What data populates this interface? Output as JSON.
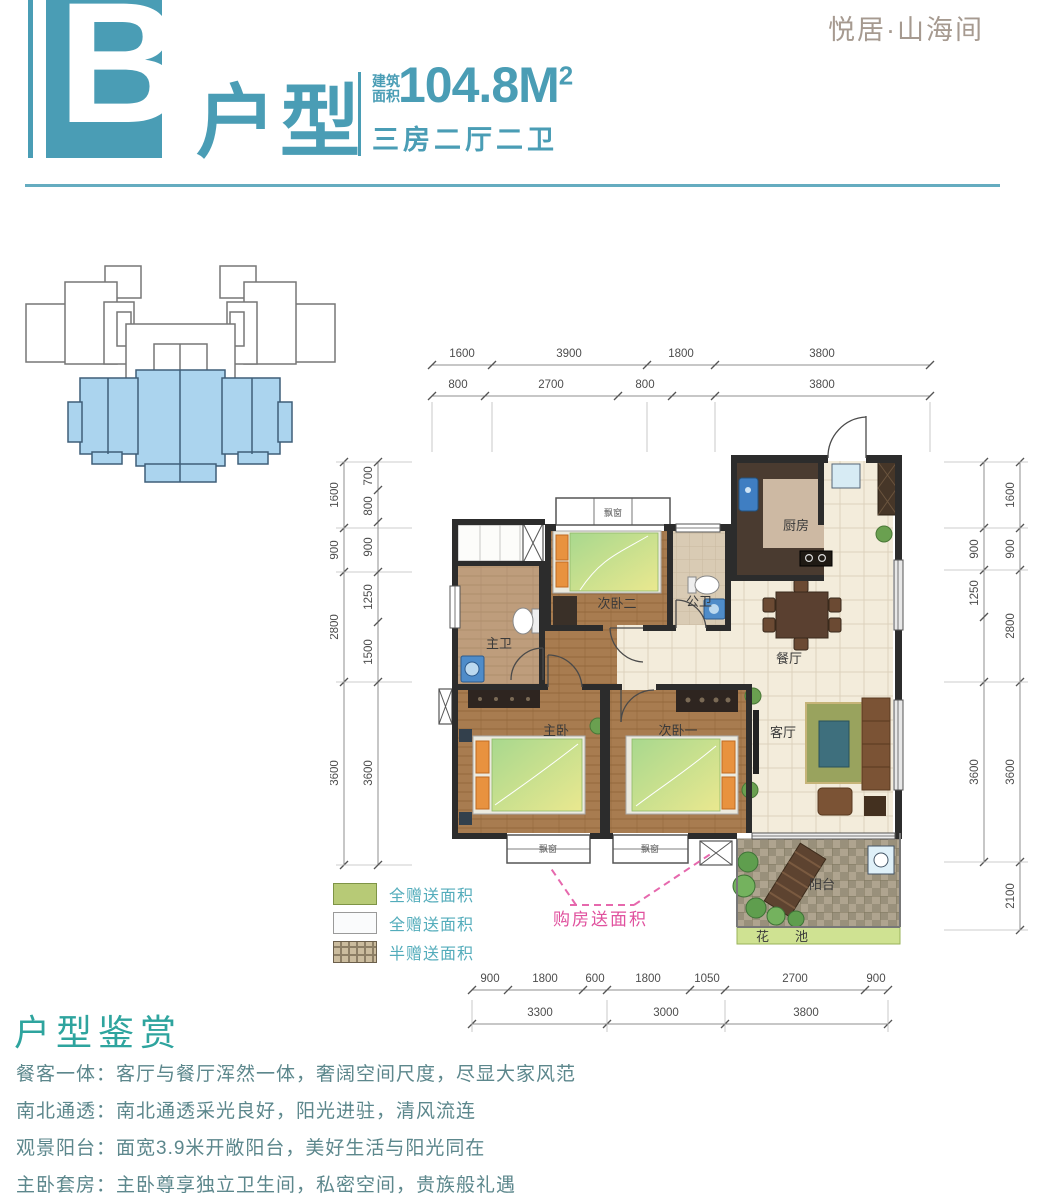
{
  "brand": "悦居·山海间",
  "header": {
    "block_letter": "B",
    "unit_type": "户型",
    "area_label_line1": "建筑",
    "area_label_line2": "面积",
    "area_value": "104.8M",
    "area_sup": "2",
    "layout_desc": "三房二厅二卫"
  },
  "floor_plan": {
    "rooms": {
      "bedroom2": "次卧二",
      "guest_bath": "公卫",
      "kitchen": "厨房",
      "dining": "餐厅",
      "master_bath": "主卫",
      "master_bedroom": "主卧",
      "bedroom1": "次卧一",
      "living": "客厅",
      "balcony": "阳台",
      "flower_bed": "花池",
      "bay_window": "飘窗"
    },
    "callout": "购房送面积"
  },
  "dimensions": {
    "top_row1": [
      "1600",
      "3900",
      "1800",
      "3800"
    ],
    "top_row2": [
      "800",
      "2700",
      "800",
      "3800"
    ],
    "bottom_row1": [
      "900",
      "1800",
      "600",
      "1800",
      "1050",
      "2700",
      "900"
    ],
    "bottom_row2": [
      "3300",
      "3000",
      "3800"
    ],
    "left_outer": [
      "1600",
      "900",
      "2800",
      "3600"
    ],
    "left_inner": [
      "700",
      "800",
      "900",
      "1250",
      "1500",
      "3600"
    ],
    "right_inner": [
      "900",
      "1250",
      "3600"
    ],
    "right_outer": [
      "1600",
      "900",
      "2800",
      "3600",
      "2100"
    ]
  },
  "legend": {
    "items": [
      {
        "label": "全赠送面积",
        "swatch": "green"
      },
      {
        "label": "全赠送面积",
        "swatch": "white"
      },
      {
        "label": "半赠送面积",
        "swatch": "hatch"
      }
    ]
  },
  "appreciation": {
    "title": "户型鉴赏",
    "items": [
      "餐客一体：客厅与餐厅浑然一体，奢阔空间尺度，尽显大家风范",
      "南北通透：南北通透采光良好，阳光进驻，清风流连",
      "观景阳台：面宽3.9米开敞阳台，美好生活与阳光同在",
      "主卧套房：主卧尊享独立卫生间，私密空间，贵族般礼遇"
    ]
  },
  "colors": {
    "accent_teal": "#4A9DB5",
    "brand_text": "#A69A90",
    "section_title_green": "#2EA49E",
    "body_text": "#5C878C",
    "legend_text": "#53ACBB",
    "gift_callout_pink": "#E0519E",
    "legend_green": "#B7CA76",
    "site_highlight_blue": "#ABD4EE",
    "wall": "#2C2C2C"
  }
}
